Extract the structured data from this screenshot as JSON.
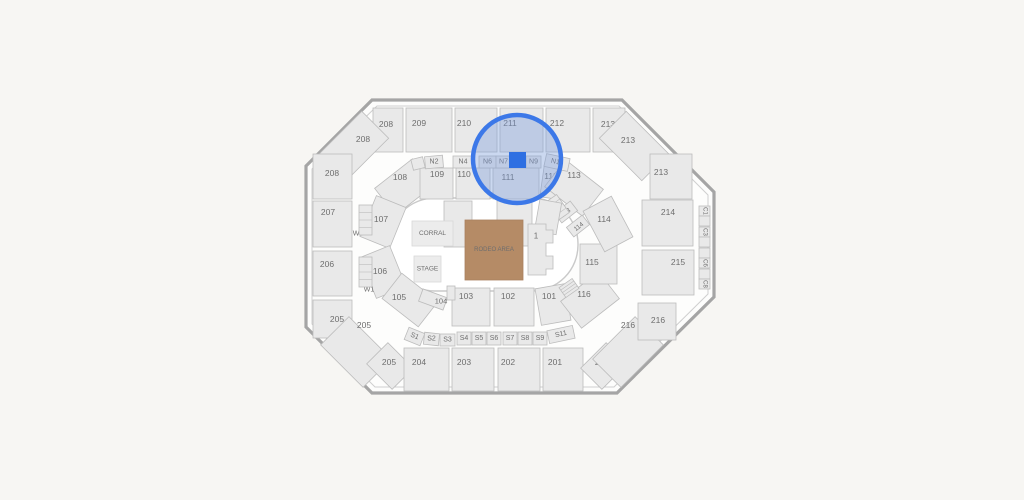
{
  "app": {
    "background": "#f7f6f3"
  },
  "map": {
    "canvas": {
      "width": 1024,
      "height": 500
    },
    "venue": {
      "wall_outer": "372,100 622,100 714,192 714,297 617,393 372,393 306,327 306,166",
      "wall_inner": "377,106 619,106 708,195 708,294 614,387 375,387 312,324 312,169",
      "wall_color": "#a5a5a5",
      "inner_line_color": "#cfcfcf",
      "floor_fill": "#fdfdfc",
      "bowl": {
        "x": 389,
        "y": 198,
        "w": 189,
        "h": 93,
        "r": 46,
        "stroke": "#c9c9c9",
        "fill": "#ffffff"
      }
    },
    "styles": {
      "section_fill": "#e9e9e9",
      "section_stroke": "#bcbcbc",
      "label_color": "#6e6e6e",
      "selected_fill": "#2e6fe2",
      "default_label_size": 8.5
    },
    "floor": {
      "corral": {
        "label": "CORRAL",
        "x": 412,
        "y": 221,
        "w": 41,
        "h": 25,
        "fill": "#ececec",
        "stroke": "#d8d8d8",
        "fs": 6.5
      },
      "stage": {
        "label": "STAGE",
        "x": 414,
        "y": 256,
        "w": 27,
        "h": 26,
        "fill": "#ececec",
        "stroke": "#d8d8d8",
        "fs": 6.5
      },
      "rodeo": {
        "label": "RODEO AREA",
        "x": 465,
        "y": 220,
        "w": 58,
        "h": 60,
        "fill": "#b58b66",
        "stroke": "#aa8160",
        "label_color": "#8a6849",
        "fs": 6
      },
      "section1": {
        "label": "1",
        "path": "M528,224 L546,224 L546,230 L553,230 L553,243 L546,243 L546,256 L553,256 L553,269 L546,269 L546,275 L528,275 Z",
        "lx": 536,
        "ly": 236,
        "fs": 8
      }
    },
    "highlight": {
      "cx": 517,
      "cy": 159,
      "r": 44,
      "ring_color": "#3c78e8",
      "ring_width": 4.5,
      "tint": "rgba(120,156,220,0.38)",
      "selected_section": {
        "x": 509,
        "y": 152,
        "w": 17,
        "h": 16
      }
    },
    "sections": [
      {
        "label": "208",
        "x": 373,
        "y": 108,
        "w": 30,
        "h": 44,
        "lx": 386,
        "ly": 124
      },
      {
        "label": "208",
        "x": 324,
        "y": 127,
        "w": 60,
        "h": 38,
        "rot": -45,
        "lx": 363,
        "ly": 139
      },
      {
        "label": "208",
        "x": 313,
        "y": 154,
        "w": 39,
        "h": 45,
        "lx": 332,
        "ly": 173
      },
      {
        "label": "209",
        "x": 406,
        "y": 108,
        "w": 46,
        "h": 44,
        "lx": 419,
        "ly": 123
      },
      {
        "label": "210",
        "x": 455,
        "y": 108,
        "w": 42,
        "h": 44,
        "lx": 464,
        "ly": 123
      },
      {
        "label": "211",
        "x": 500,
        "y": 108,
        "w": 43,
        "h": 44,
        "lx": 510,
        "ly": 123
      },
      {
        "label": "212",
        "x": 546,
        "y": 108,
        "w": 44,
        "h": 44,
        "lx": 557,
        "ly": 123
      },
      {
        "label": "213",
        "x": 593,
        "y": 108,
        "w": 32,
        "h": 44,
        "lx": 608,
        "ly": 124
      },
      {
        "label": "213",
        "x": 604,
        "y": 127,
        "w": 60,
        "h": 38,
        "rot": 45,
        "lx": 628,
        "ly": 140
      },
      {
        "label": "213",
        "x": 650,
        "y": 154,
        "w": 42,
        "h": 45,
        "lx": 661,
        "ly": 172
      },
      {
        "label": "207",
        "x": 313,
        "y": 201,
        "w": 39,
        "h": 46,
        "lx": 328,
        "ly": 212
      },
      {
        "label": "206",
        "x": 313,
        "y": 251,
        "w": 39,
        "h": 45,
        "lx": 327,
        "ly": 264
      },
      {
        "label": "205",
        "x": 313,
        "y": 300,
        "w": 39,
        "h": 38,
        "lx": 337,
        "ly": 319
      },
      {
        "label": "205",
        "x": 326,
        "y": 332,
        "w": 60,
        "h": 40,
        "rot": 45,
        "lx": 364,
        "ly": 325
      },
      {
        "label": "205",
        "x": 372,
        "y": 351,
        "w": 36,
        "h": 30,
        "rot": 45,
        "lx": 389,
        "ly": 362
      },
      {
        "label": "204",
        "x": 404,
        "y": 348,
        "w": 45,
        "h": 43,
        "lx": 419,
        "ly": 362
      },
      {
        "label": "203",
        "x": 452,
        "y": 348,
        "w": 42,
        "h": 43,
        "lx": 464,
        "ly": 362
      },
      {
        "label": "202",
        "x": 498,
        "y": 348,
        "w": 42,
        "h": 43,
        "lx": 508,
        "ly": 362
      },
      {
        "label": "201",
        "x": 543,
        "y": 348,
        "w": 40,
        "h": 43,
        "lx": 555,
        "ly": 362
      },
      {
        "label": "216",
        "x": 586,
        "y": 351,
        "w": 36,
        "h": 30,
        "rot": -45,
        "lx": 602,
        "ly": 362
      },
      {
        "label": "216",
        "x": 598,
        "y": 332,
        "w": 60,
        "h": 40,
        "rot": -45,
        "lx": 628,
        "ly": 325
      },
      {
        "label": "216",
        "x": 638,
        "y": 303,
        "w": 38,
        "h": 37,
        "lx": 658,
        "ly": 320
      },
      {
        "label": "214",
        "x": 642,
        "y": 200,
        "w": 51,
        "h": 46,
        "lx": 668,
        "ly": 212
      },
      {
        "label": "215",
        "x": 642,
        "y": 250,
        "w": 52,
        "h": 45,
        "lx": 678,
        "ly": 262
      },
      {
        "label": "108",
        "x": 380,
        "y": 170,
        "w": 48,
        "h": 34,
        "rot": -38,
        "lx": 400,
        "ly": 177
      },
      {
        "label": "109",
        "x": 420,
        "y": 168,
        "w": 33,
        "h": 31,
        "lx": 437,
        "ly": 174
      },
      {
        "label": "110",
        "x": 456,
        "y": 168,
        "w": 34,
        "h": 31,
        "lx": 464,
        "ly": 174
      },
      {
        "label": "111",
        "x": 493,
        "y": 168,
        "w": 46,
        "h": 31,
        "lx": 508,
        "ly": 177
      },
      {
        "label": "112",
        "x": 542,
        "y": 166,
        "w": 30,
        "h": 33,
        "rot": 8,
        "lx": 551,
        "ly": 176
      },
      {
        "label": "113",
        "x": 550,
        "y": 171,
        "w": 48,
        "h": 34,
        "rot": 38,
        "lx": 574,
        "ly": 175
      },
      {
        "label": "107",
        "x": 361,
        "y": 206,
        "w": 44,
        "h": 32,
        "rot": -68,
        "lx": 381,
        "ly": 219
      },
      {
        "label": "106",
        "x": 361,
        "y": 256,
        "w": 44,
        "h": 32,
        "rot": 68,
        "lx": 380,
        "ly": 271
      },
      {
        "label": "105",
        "x": 387,
        "y": 284,
        "w": 46,
        "h": 32,
        "rot": 38,
        "lx": 399,
        "ly": 297
      },
      {
        "label": "104",
        "x": 420,
        "y": 293,
        "w": 26,
        "h": 13,
        "rot": 20,
        "lx": 441,
        "ly": 301,
        "fs": 7.5
      },
      {
        "label": "103",
        "x": 452,
        "y": 288,
        "w": 38,
        "h": 38,
        "lx": 466,
        "ly": 296
      },
      {
        "label": "102",
        "x": 494,
        "y": 288,
        "w": 40,
        "h": 38,
        "lx": 508,
        "ly": 296
      },
      {
        "label": "101",
        "x": 538,
        "y": 286,
        "w": 30,
        "h": 37,
        "rot": -10,
        "lx": 549,
        "ly": 296
      },
      {
        "label": "116",
        "x": 566,
        "y": 283,
        "w": 48,
        "h": 34,
        "rot": -38,
        "lx": 584,
        "ly": 294
      },
      {
        "label": "115",
        "x": 580,
        "y": 244,
        "w": 37,
        "h": 40,
        "lx": 592,
        "ly": 262
      },
      {
        "label": "114",
        "x": 585,
        "y": 208,
        "w": 46,
        "h": 32,
        "rot": 62,
        "lx": 604,
        "ly": 219
      },
      {
        "label": "113",
        "x": 556,
        "y": 206,
        "w": 20,
        "h": 12,
        "rot": -38,
        "lx": 566,
        "ly": 213,
        "fs": 6.5,
        "lrot": -38
      },
      {
        "label": "114",
        "x": 568,
        "y": 220,
        "w": 20,
        "h": 12,
        "rot": -38,
        "lx": 579,
        "ly": 227,
        "fs": 6.5,
        "lrot": -38
      },
      {
        "label": "W5",
        "ghost": true,
        "x": 352,
        "y": 228,
        "w": 13,
        "h": 12,
        "lx": 358,
        "ly": 234,
        "fs": 7
      },
      {
        "label": "W1",
        "ghost": true,
        "x": 363,
        "y": 284,
        "w": 13,
        "h": 12,
        "lx": 369,
        "ly": 290,
        "fs": 7
      },
      {
        "label": "",
        "type": "stairs",
        "x": 359,
        "y": 205,
        "w": 13,
        "h": 30
      },
      {
        "label": "",
        "type": "stairs",
        "x": 359,
        "y": 257,
        "w": 13,
        "h": 30
      },
      {
        "label": "",
        "type": "stairs",
        "x": 552,
        "y": 196,
        "w": 12,
        "h": 22,
        "rot": -35
      },
      {
        "label": "",
        "type": "stairs",
        "x": 561,
        "y": 282,
        "w": 16,
        "h": 12,
        "rot": -35
      },
      {
        "label": "",
        "x": 444,
        "y": 201,
        "w": 28,
        "h": 46
      },
      {
        "label": "",
        "x": 497,
        "y": 201,
        "w": 35,
        "h": 45
      },
      {
        "label": "",
        "x": 537,
        "y": 201,
        "w": 22,
        "h": 32,
        "rot": 10
      },
      {
        "label": "",
        "x": 447,
        "y": 286,
        "w": 8,
        "h": 14
      },
      {
        "label": "",
        "x": 412,
        "y": 158,
        "w": 12,
        "h": 11,
        "rot": -14
      },
      {
        "label": "N2",
        "x": 425,
        "y": 156,
        "w": 18,
        "h": 12,
        "rot": -5,
        "fs": 7
      },
      {
        "label": "N4",
        "x": 453,
        "y": 156,
        "w": 20,
        "h": 12,
        "fs": 7
      },
      {
        "label": "N6",
        "x": 479,
        "y": 156,
        "w": 17,
        "h": 12,
        "fs": 7
      },
      {
        "label": "N7",
        "x": 496,
        "y": 156,
        "w": 15,
        "h": 12,
        "fs": 7
      },
      {
        "label": "N9",
        "x": 526,
        "y": 156,
        "w": 15,
        "h": 12,
        "fs": 7
      },
      {
        "label": "N11",
        "x": 545,
        "y": 156,
        "w": 24,
        "h": 13,
        "rot": 12,
        "fs": 7,
        "lrot": 12
      },
      {
        "label": "S1",
        "x": 406,
        "y": 330,
        "w": 17,
        "h": 13,
        "rot": 22,
        "fs": 7,
        "lrot": 22
      },
      {
        "label": "S2",
        "x": 424,
        "y": 333,
        "w": 15,
        "h": 12,
        "rot": 6,
        "fs": 7
      },
      {
        "label": "S3",
        "x": 440,
        "y": 334,
        "w": 15,
        "h": 12,
        "fs": 7
      },
      {
        "label": "S4",
        "x": 457,
        "y": 332,
        "w": 14,
        "h": 13,
        "fs": 7
      },
      {
        "label": "S5",
        "x": 472,
        "y": 332,
        "w": 14,
        "h": 13,
        "fs": 7
      },
      {
        "label": "S6",
        "x": 487,
        "y": 332,
        "w": 14,
        "h": 13,
        "fs": 7
      },
      {
        "label": "S7",
        "x": 503,
        "y": 332,
        "w": 14,
        "h": 13,
        "fs": 7
      },
      {
        "label": "S8",
        "x": 518,
        "y": 332,
        "w": 14,
        "h": 13,
        "fs": 7
      },
      {
        "label": "S9",
        "x": 533,
        "y": 332,
        "w": 14,
        "h": 13,
        "fs": 7
      },
      {
        "label": "S11",
        "x": 548,
        "y": 328,
        "w": 26,
        "h": 13,
        "rot": -12,
        "fs": 7,
        "lrot": -12
      },
      {
        "label": "C1",
        "x": 699,
        "y": 206,
        "w": 11,
        "h": 10,
        "fs": 6,
        "lrot": 90
      },
      {
        "label": "",
        "x": 699,
        "y": 216,
        "w": 11,
        "h": 10,
        "fs": 6
      },
      {
        "label": "C3",
        "x": 699,
        "y": 227,
        "w": 11,
        "h": 10,
        "fs": 6,
        "lrot": 90
      },
      {
        "label": "",
        "x": 699,
        "y": 237,
        "w": 11,
        "h": 10,
        "fs": 6
      },
      {
        "label": "",
        "x": 699,
        "y": 248,
        "w": 11,
        "h": 10,
        "fs": 6
      },
      {
        "label": "C6",
        "x": 699,
        "y": 258,
        "w": 11,
        "h": 10,
        "fs": 6,
        "lrot": 90
      },
      {
        "label": "",
        "x": 699,
        "y": 269,
        "w": 11,
        "h": 10,
        "fs": 6
      },
      {
        "label": "C8",
        "x": 699,
        "y": 279,
        "w": 11,
        "h": 10,
        "fs": 6,
        "lrot": 90
      }
    ]
  }
}
